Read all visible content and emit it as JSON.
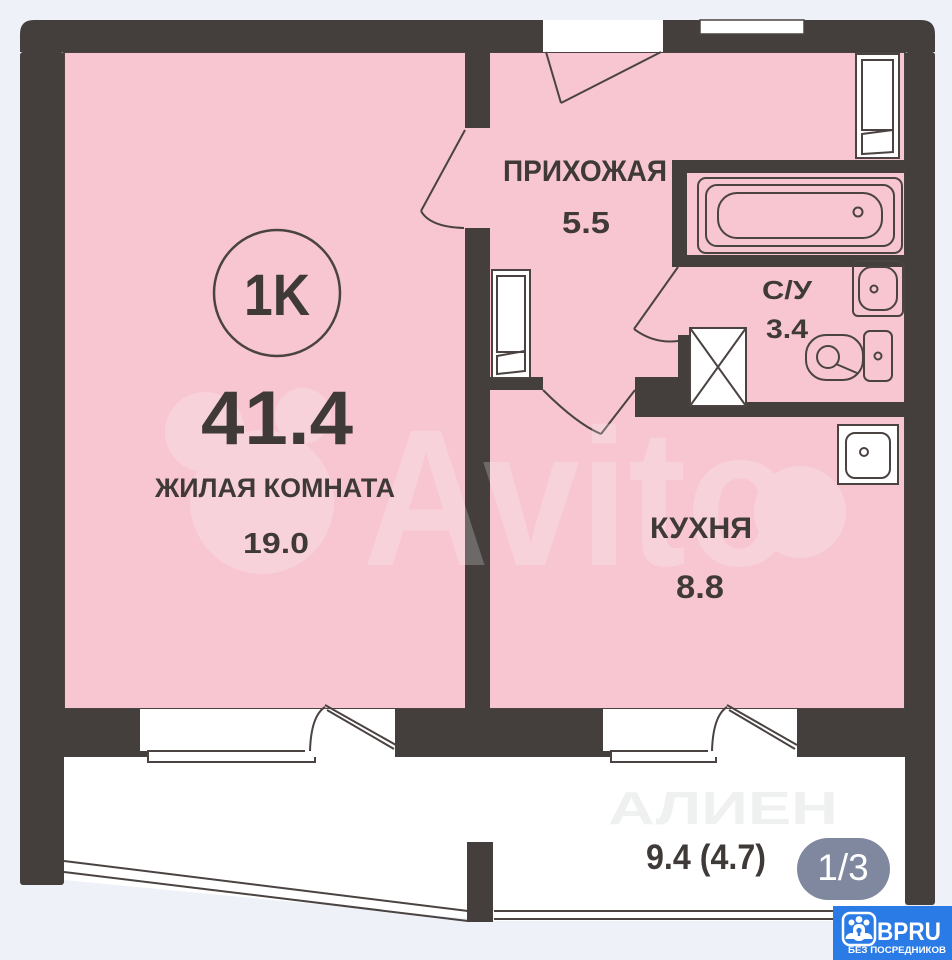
{
  "colors": {
    "page-bg": "#eef2f8",
    "wall": "#443f3d",
    "room-pink": "#f7c6d1",
    "line": "#4a4341",
    "label": "#3f3a38",
    "badge-bg": "#767f99",
    "brand-blue": "#2b7be7"
  },
  "plan": {
    "type_badge": "1K",
    "total_area": "41.4",
    "rooms": [
      {
        "id": "living",
        "label": "ЖИЛАЯ КОМНАТА",
        "area": "19.0"
      },
      {
        "id": "hallway",
        "label": "ПРИХОЖАЯ",
        "area": "5.5"
      },
      {
        "id": "su",
        "label": "С/У",
        "area": "3.4"
      },
      {
        "id": "kitchen",
        "label": "КУХНЯ",
        "area": "8.8"
      },
      {
        "id": "balcony",
        "label": "",
        "area": "9.4 (4.7)"
      }
    ]
  },
  "overlay": {
    "photo_counter": "1/3"
  },
  "watermarks": {
    "primary": "Avito",
    "secondary": "АЛИЕН"
  },
  "logo": {
    "brand": "BPRU",
    "tagline": "БЕЗ ПОСРЕДНИКОВ"
  }
}
